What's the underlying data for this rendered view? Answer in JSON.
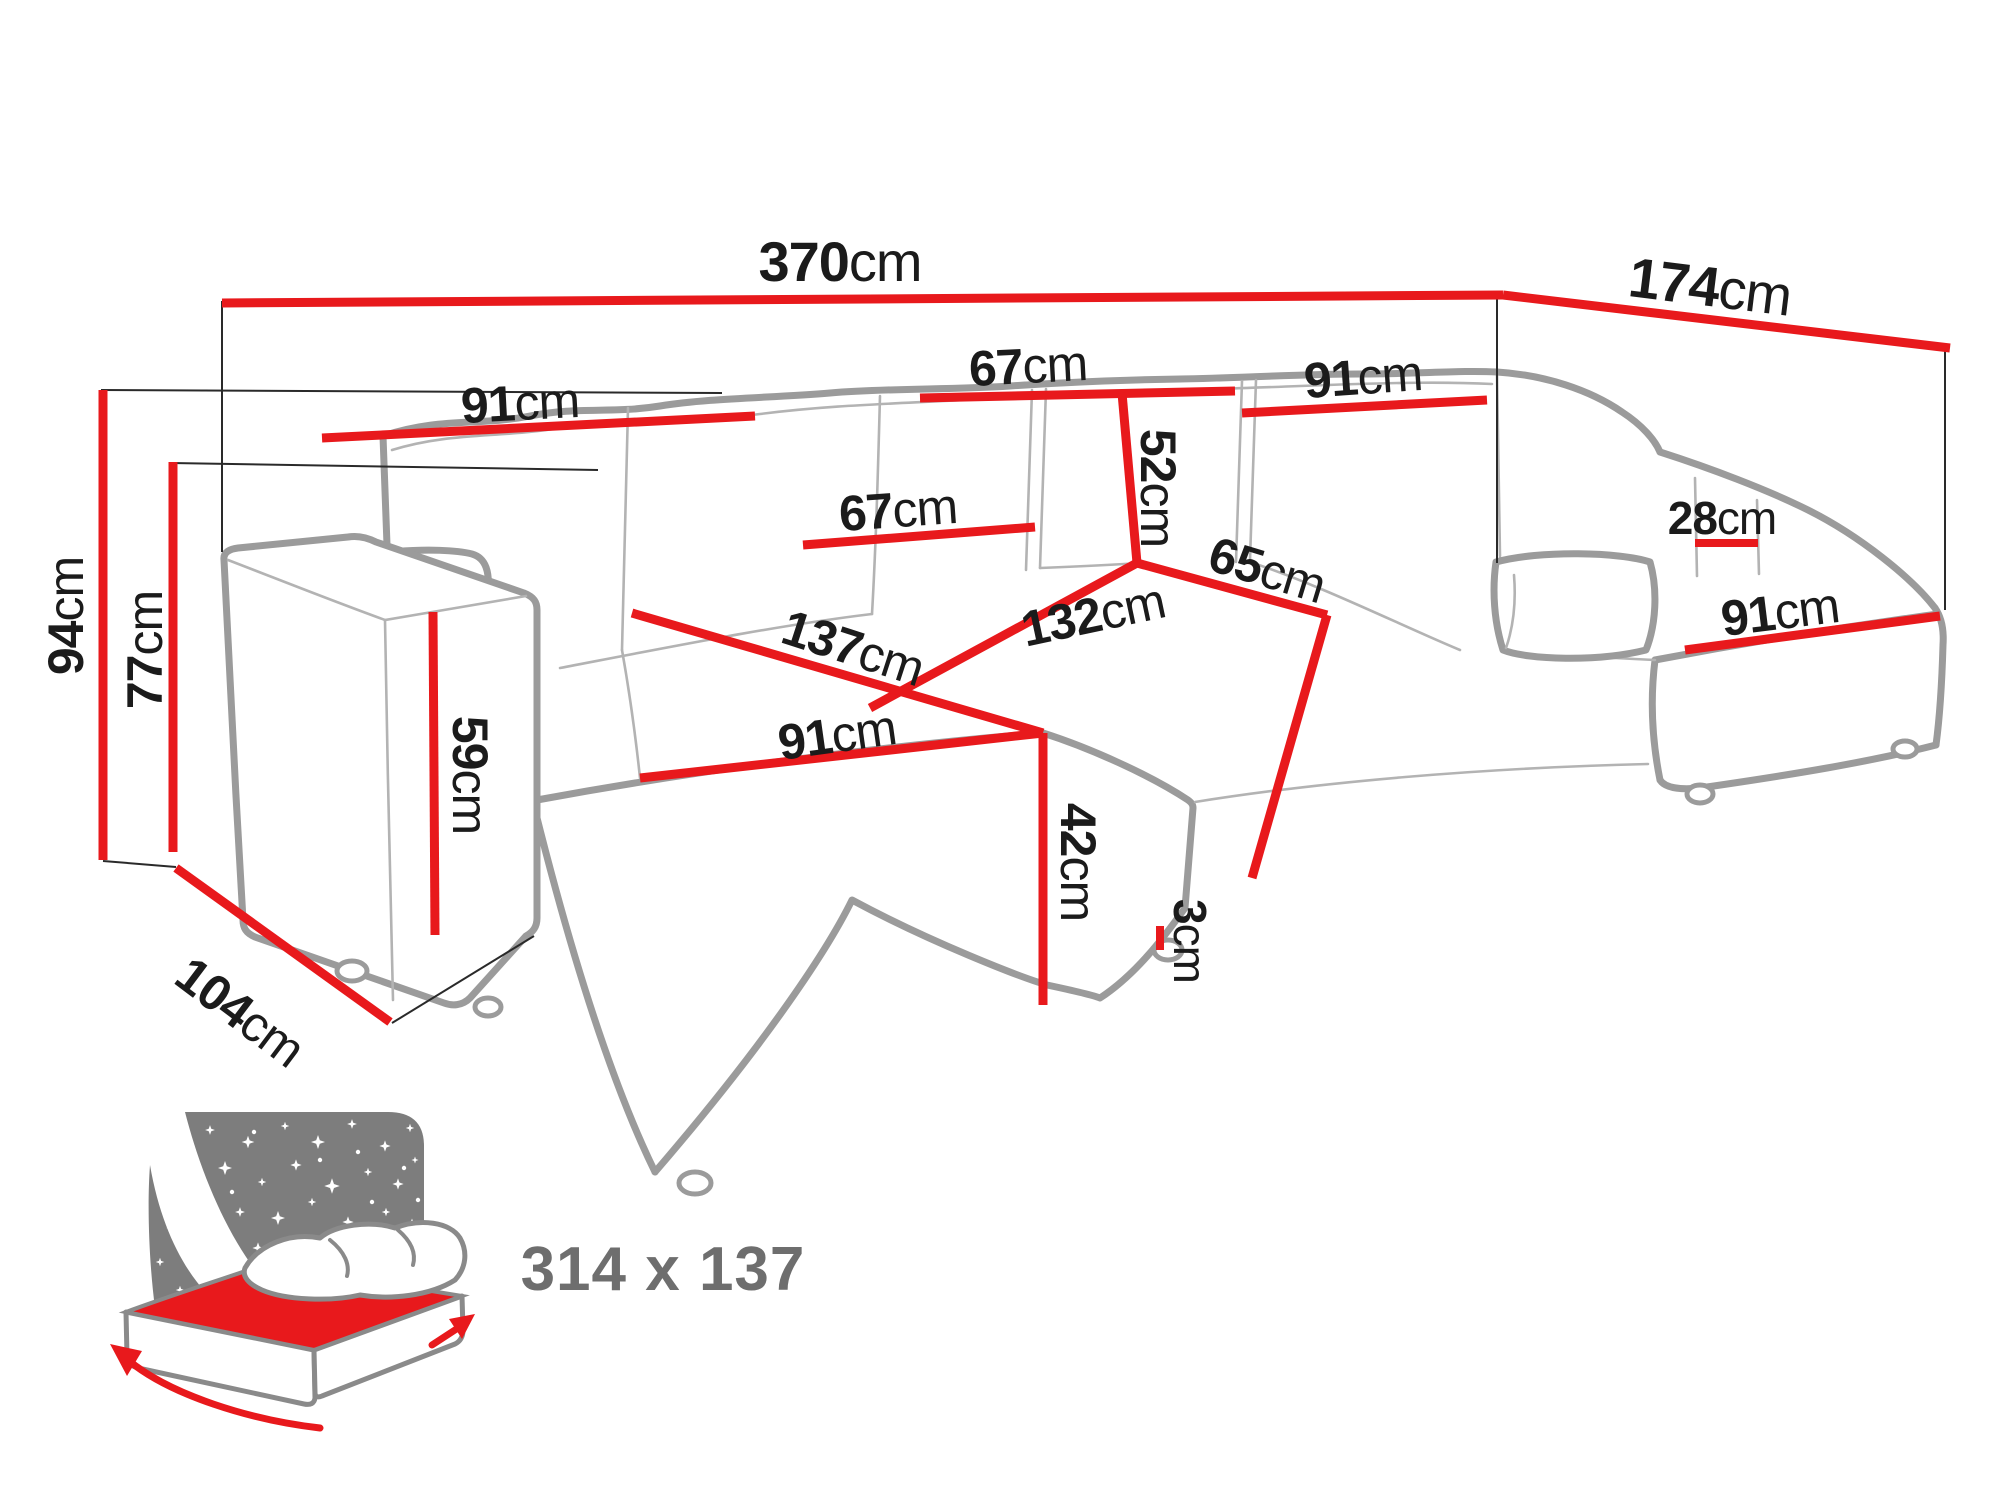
{
  "title": "U-shaped corner sofa bed dimensions diagram",
  "colors": {
    "dimension_red": "#e8191c",
    "outline_gray": "#9b9b9b",
    "text_black": "#1b1b1b",
    "icon_gray": "#7d7d7d",
    "icon_text_gray": "#6e6e6e",
    "background": "#ffffff"
  },
  "dims": {
    "total_width": {
      "value": "370",
      "unit": "cm"
    },
    "total_depth_right": {
      "value": "174",
      "unit": "cm"
    },
    "back_left_width": {
      "value": "91",
      "unit": "cm"
    },
    "back_top_cushion": {
      "value": "67",
      "unit": "cm"
    },
    "back_right_width": {
      "value": "91",
      "unit": "cm"
    },
    "backrest_height": {
      "value": "52",
      "unit": "cm"
    },
    "right_armrest_width": {
      "value": "28",
      "unit": "cm"
    },
    "left_cushion_width": {
      "value": "67",
      "unit": "cm"
    },
    "corner_seat_depth": {
      "value": "65",
      "unit": "cm"
    },
    "middle_seat_width": {
      "value": "132",
      "unit": "cm"
    },
    "chaise_length": {
      "value": "137",
      "unit": "cm"
    },
    "chaise_width": {
      "value": "91",
      "unit": "cm"
    },
    "right_seat_depth": {
      "value": "91",
      "unit": "cm"
    },
    "seat_height": {
      "value": "42",
      "unit": "cm"
    },
    "leg_height": {
      "value": "3",
      "unit": "cm"
    },
    "armrest_height": {
      "value": "59",
      "unit": "cm"
    },
    "total_height": {
      "value": "94",
      "unit": "cm"
    },
    "armrest_front_height": {
      "value": "77",
      "unit": "cm"
    },
    "side_depth": {
      "value": "104",
      "unit": "cm"
    }
  },
  "sleeping_area": {
    "label": "314 x 137"
  },
  "icons": {
    "sleeping_function": "sofa-bed-night-icon"
  }
}
